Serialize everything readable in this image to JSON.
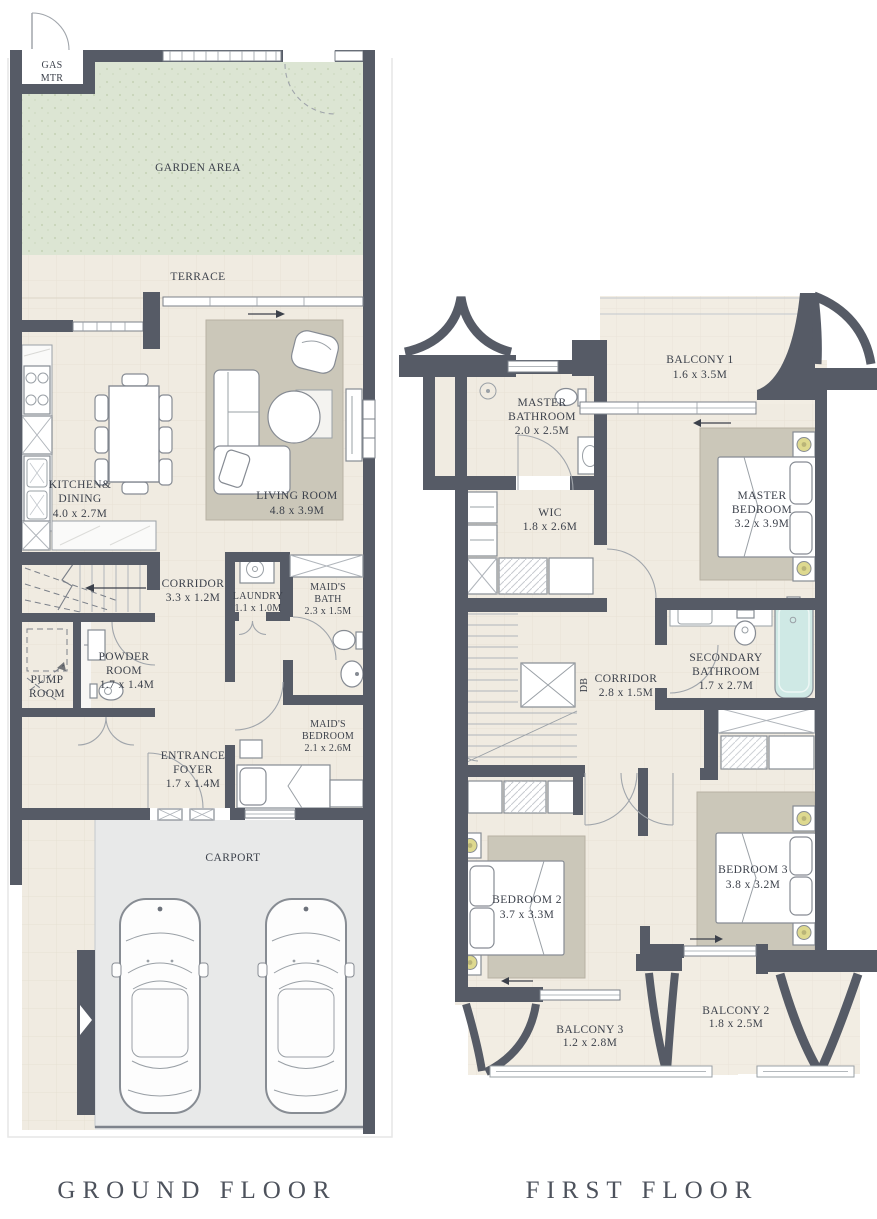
{
  "page": {
    "ground_title": "GROUND FLOOR",
    "first_title": "FIRST FLOOR"
  },
  "colors": {
    "wall": "#565b66",
    "floor": "#f0ebe1",
    "garden": "#dce5d3",
    "rug": "#cbc7b9",
    "carport": "#e8e9e9",
    "bathtub": "#cfe9e5",
    "lamp": "#ded98f",
    "text": "#3c414b"
  },
  "ground": {
    "gas": {
      "l1": "GAS",
      "l2": "MTR"
    },
    "garden": {
      "name": "GARDEN AREA"
    },
    "terrace": {
      "name": "TERRACE"
    },
    "kitchen": {
      "l1": "KITCHEN&",
      "l2": "DINING",
      "dims": "4.0 x 2.7M"
    },
    "living": {
      "name": "LIVING ROOM",
      "dims": "4.8 x 3.9M"
    },
    "corridor": {
      "name": "CORRIDOR",
      "dims": "3.3 x 1.2M"
    },
    "laundry": {
      "name": "LAUNDRY",
      "dims": "1.1 x 1.0M"
    },
    "maids_bath": {
      "l1": "MAID'S",
      "l2": "BATH",
      "dims": "2.3 x 1.5M"
    },
    "pump": {
      "l1": "PUMP",
      "l2": "ROOM"
    },
    "powder": {
      "l1": "POWDER",
      "l2": "ROOM",
      "dims": "1.7 x 1.4M"
    },
    "foyer": {
      "l1": "ENTRANCE",
      "l2": "FOYER",
      "dims": "1.7 x 1.4M"
    },
    "maids_bedroom": {
      "l1": "MAID'S",
      "l2": "BEDROOM",
      "dims": "2.1 x 2.6M"
    },
    "carport": {
      "name": "CARPORT"
    }
  },
  "first": {
    "balcony1": {
      "name": "BALCONY 1",
      "dims": "1.6 x 3.5M"
    },
    "master_bath": {
      "l1": "MASTER",
      "l2": "BATHROOM",
      "dims": "2.0 x 2.5M"
    },
    "wic": {
      "name": "WIC",
      "dims": "1.8 x 2.6M"
    },
    "master_bedroom": {
      "l1": "MASTER",
      "l2": "BEDROOM",
      "dims": "3.2 x 3.9M"
    },
    "secondary_bath": {
      "l1": "SECONDARY",
      "l2": "BATHROOM",
      "dims": "1.7 x 2.7M"
    },
    "corridor": {
      "name": "CORRIDOR",
      "dims": "2.8 x 1.5M"
    },
    "db": {
      "name": "DB"
    },
    "bedroom2": {
      "name": "BEDROOM 2",
      "dims": "3.7 x 3.3M"
    },
    "bedroom3": {
      "name": "BEDROOM 3",
      "dims": "3.8 x 3.2M"
    },
    "balcony3": {
      "name": "BALCONY 3",
      "dims": "1.2 x 2.8M"
    },
    "balcony2": {
      "name": "BALCONY 2",
      "dims": "1.8 x 2.5M"
    }
  }
}
